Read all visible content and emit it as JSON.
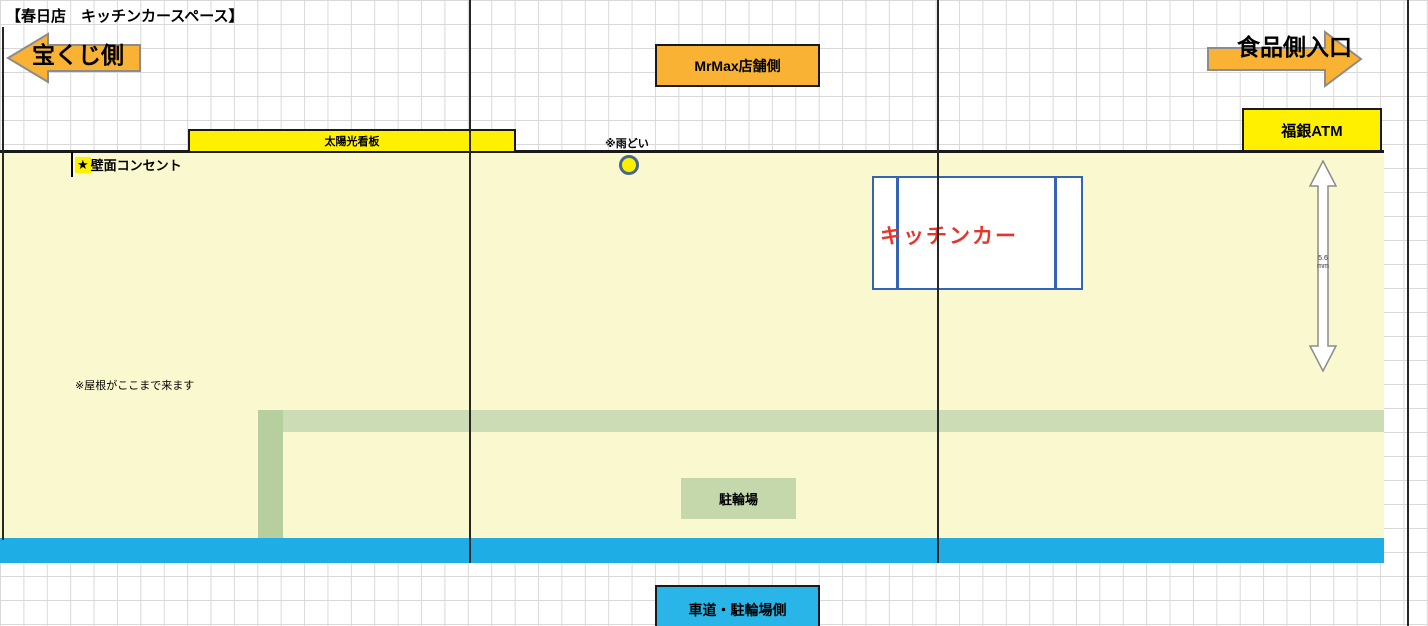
{
  "title": "【春日店　キッチンカースペース】",
  "directions": {
    "left_arrow_label": "宝くじ側",
    "right_arrow_label": "食品側入口"
  },
  "labels": {
    "store_side": "MrMax店舗側",
    "atm": "福銀ATM",
    "solar_sign": "太陽光看板",
    "rain_gutter_note": "※雨どい",
    "wall_outlet_star": "★",
    "wall_outlet": "壁面コンセント",
    "kitchen_car": "キッチンカー",
    "roof_note": "※屋根がここまで来ます",
    "bicycle_parking": "駐輪場",
    "road_side": "車道・駐輪場側",
    "measure_value": "5.6",
    "measure_unit": "mm"
  },
  "colors": {
    "accent_orange": "#F9B234",
    "bright_yellow": "#FFF000",
    "area_yellow": "#FAF8CE",
    "path_green": "#CCDCB4",
    "stripe_green": "#B7CF9E",
    "parking_green": "#C5D8AC",
    "road_blue": "#1FADE6",
    "box_blue_border": "#3465B4",
    "kitchen_car_red": "#E8352B",
    "grid_gray": "#D9D9D9",
    "line_black": "#1A1A1A",
    "arrow_border_gray": "#8C8C8C"
  }
}
